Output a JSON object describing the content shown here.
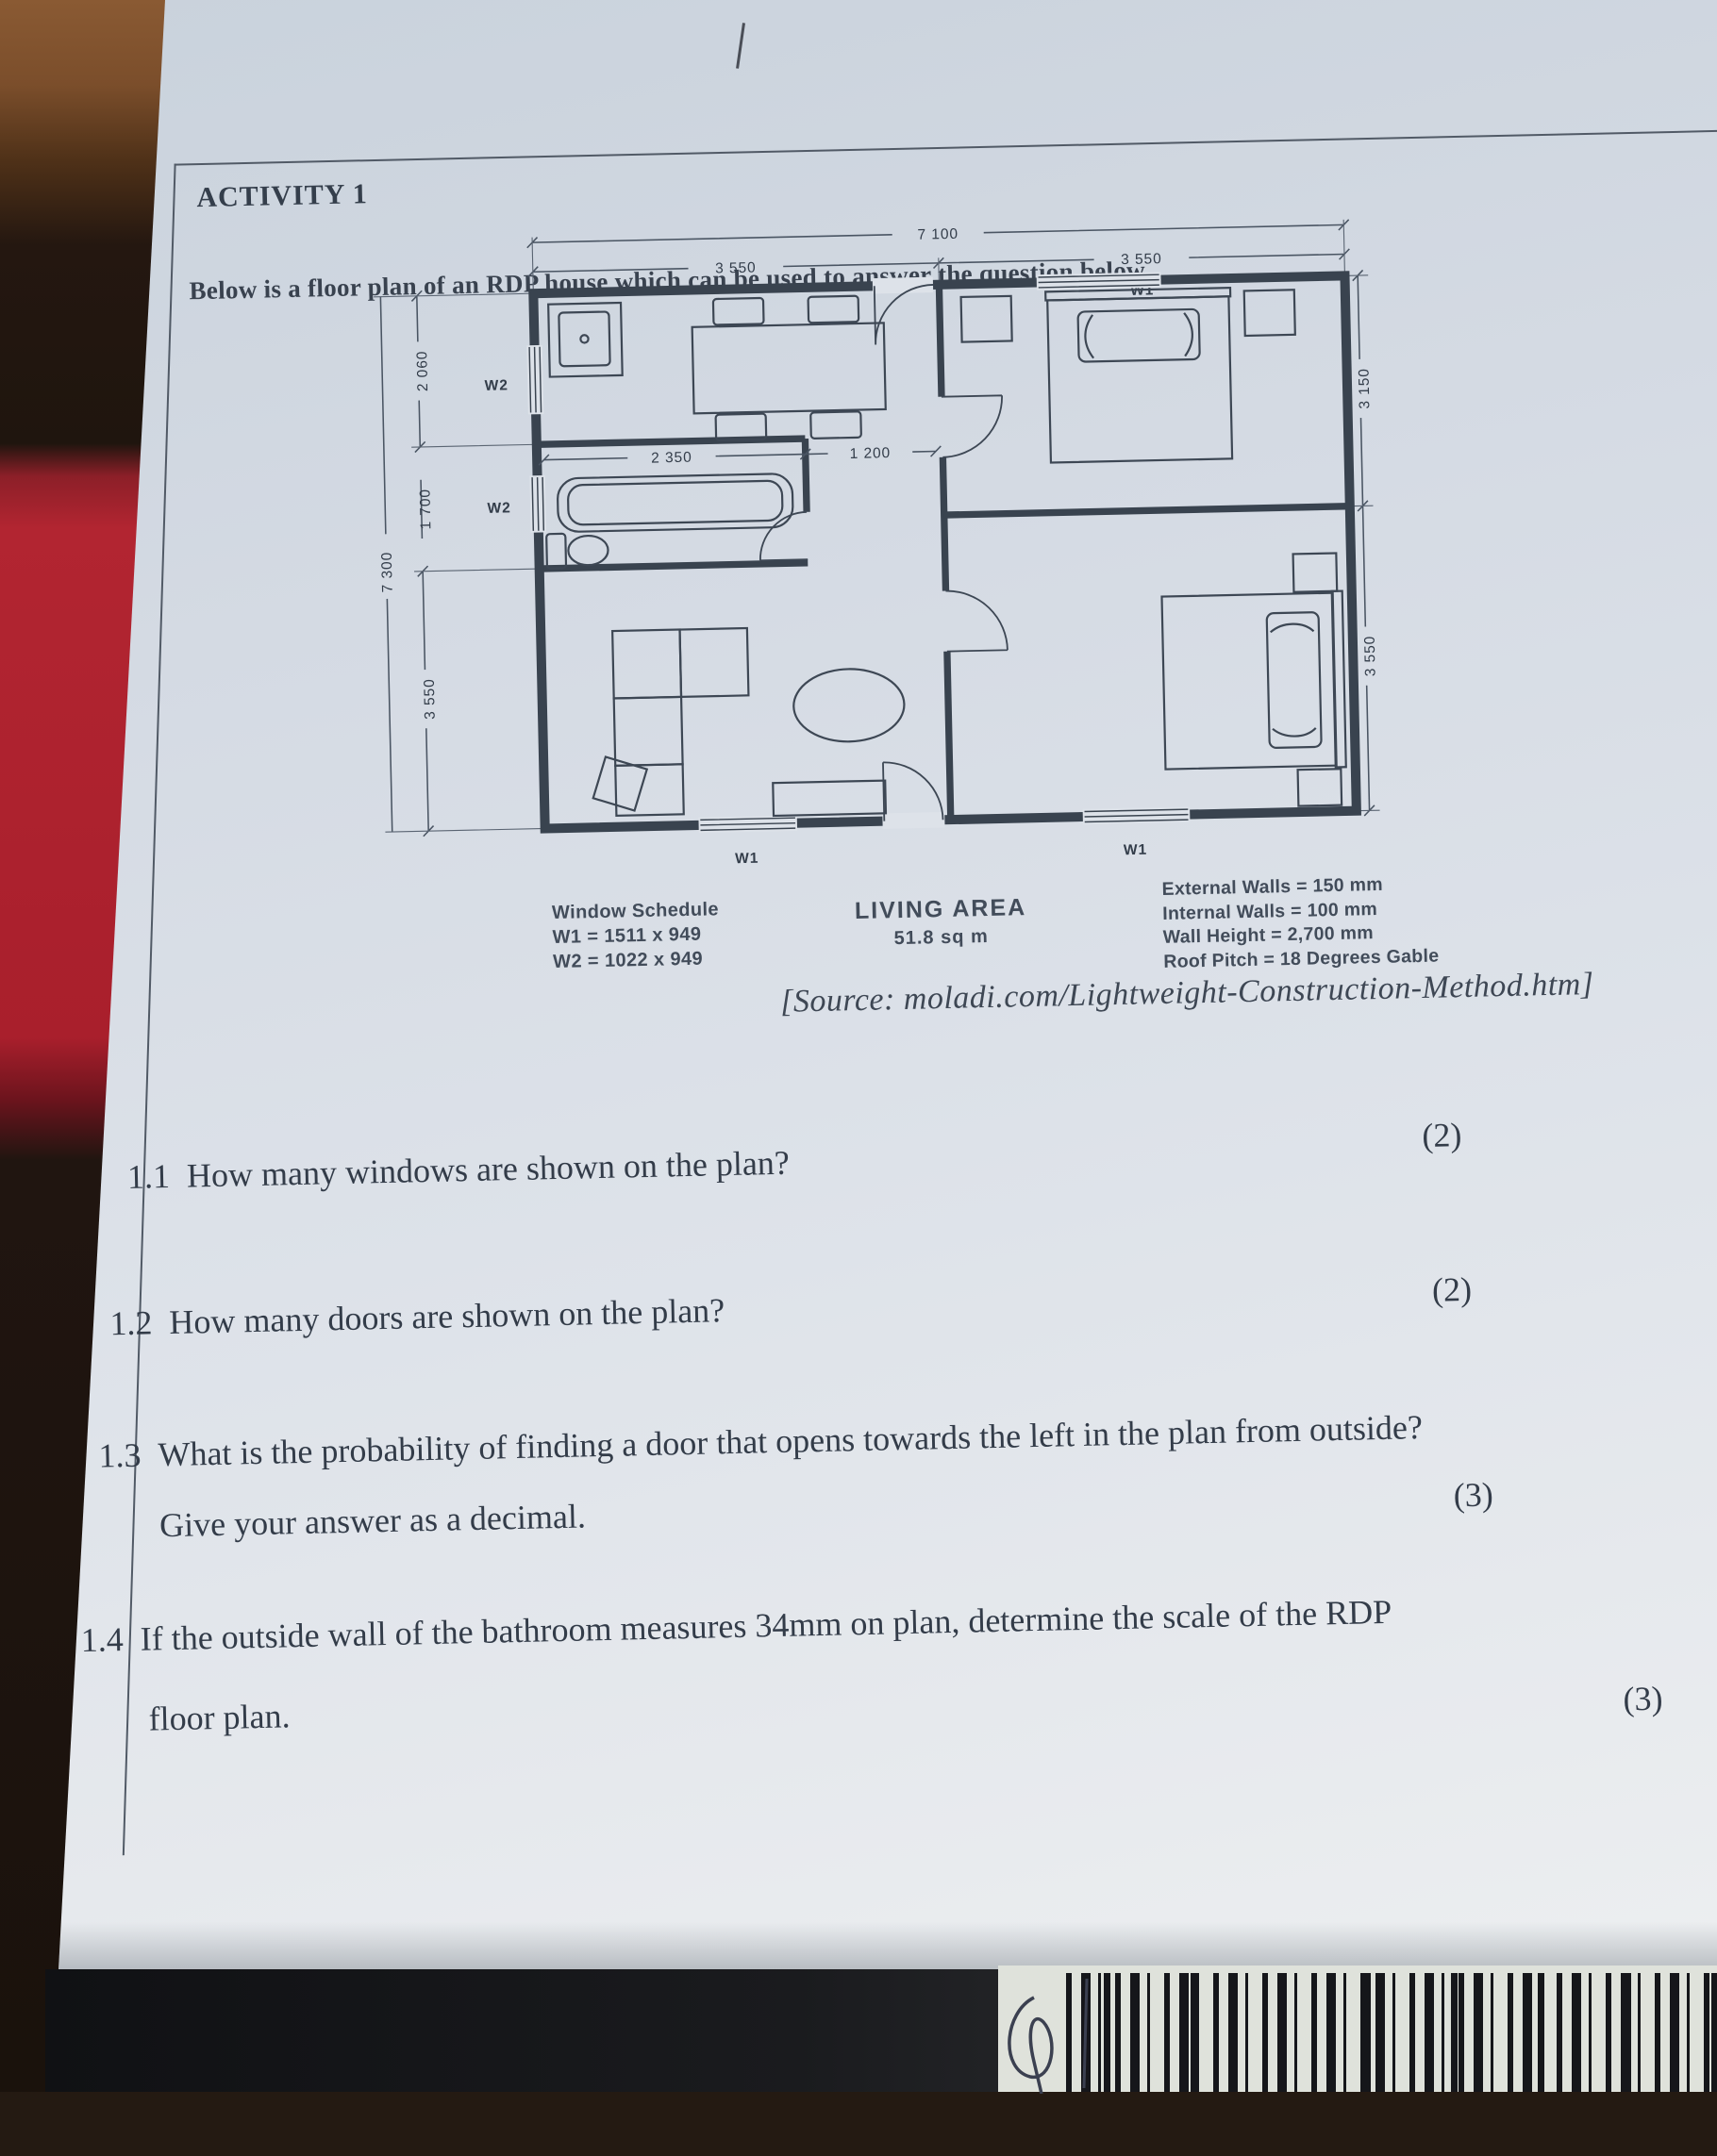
{
  "colors": {
    "paper": "#dde2e9",
    "ink": "#333c49",
    "plan_line": "#39434f",
    "red_book": "#b22531",
    "wood_table": "#7b4e2b",
    "bottom_band": "#17181a"
  },
  "header": {
    "activity_title": "ACTIVITY 1",
    "intro": "Below is a floor plan of an RDP house which can be used to answer the question below."
  },
  "floor_plan": {
    "dim_overall_width": "7 100",
    "dim_top_left": "3 550",
    "dim_top_right": "3 550",
    "dim_overall_depth": "7 300",
    "dim_left_top": "2 060",
    "dim_left_mid": "1 700",
    "dim_left_bottom": "3 550",
    "dim_right_top": "3 150",
    "dim_right_bottom": "3 550",
    "dim_kitchen": "2 350",
    "dim_hall": "1 200",
    "label_w1": "W1",
    "label_w2": "W2",
    "schedule_title": "Window Schedule",
    "schedule_w1": "W1 = 1511 x 949",
    "schedule_w2": "W2 = 1022 x 949",
    "living_area_title": "LIVING AREA",
    "living_area_value": "51.8 sq m",
    "specs": [
      "External Walls = 150 mm",
      "Internal Walls = 100 mm",
      "Wall Height = 2,700 mm",
      "Roof Pitch = 18 Degrees Gable"
    ]
  },
  "source_line": "[Source: moladi.com/Lightweight-Construction-Method.htm]",
  "questions": [
    {
      "number": "1.1",
      "text": "How many windows are shown on the plan?",
      "marks": "(2)"
    },
    {
      "number": "1.2",
      "text": "How many doors are shown on the plan?",
      "marks": "(2)"
    },
    {
      "number": "1.3",
      "text": "What is the probability of finding a door that opens towards the left in the plan from outside?",
      "text2": "Give your answer as a decimal.",
      "marks": "(3)"
    },
    {
      "number": "1.4",
      "text": "If the outside wall of the bathroom measures 34mm on plan, determine the scale of the RDP",
      "text2": "floor plan.",
      "marks": "(3)"
    }
  ]
}
